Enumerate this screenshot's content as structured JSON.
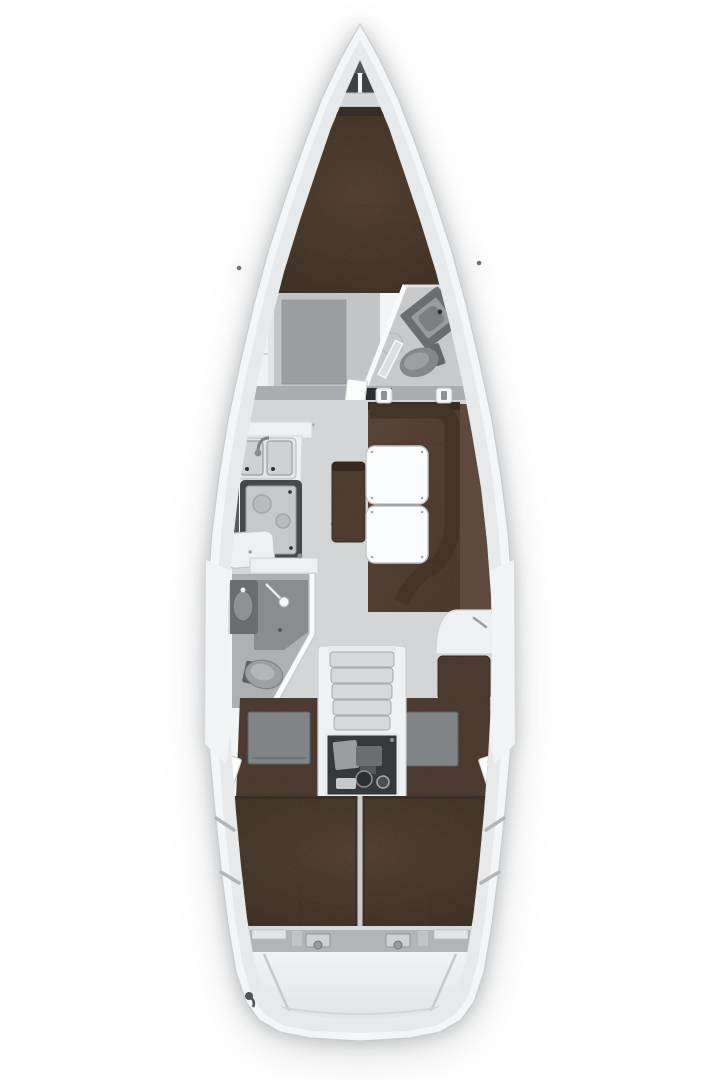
{
  "app": {
    "type": "boat-floorplan",
    "view": "top-down interior layout plan of a sailing yacht"
  },
  "palette": {
    "page_bg": "#ffffff",
    "hull": "#f4f5f6",
    "hull_stroke": "#c9ccce",
    "deck": "#e7e9ea",
    "walls": "#f3f4f5",
    "side_deck": "#f2f3f4",
    "floor": "#d3d5d7",
    "cabin_floor": "#c2c5c7",
    "rug": "#9c9fa2",
    "bath_floor": "#aeb1b4",
    "shower_floor": "#8a8d90",
    "berth_hi": "#62503f",
    "berth_lo": "#4b3b2f",
    "berth_top": "#382d26",
    "berth_edge": "#44352a",
    "sofa_seat_hi": "#6b5545",
    "sofa_seat_lo": "#5a4638",
    "sofa_back": "#443426",
    "sofa_shelf": "#5d4a3c",
    "bench": "#5f4c3c",
    "seam": "#4c3b2f",
    "table": "#fbfcfd",
    "table_stroke": "#c2c5c7",
    "counter": "#eef0f1",
    "counter_stroke": "#d0d3d5",
    "basin": "#cfd2d4",
    "basin_stroke": "#8f9295",
    "stove_frame": "#46494c",
    "stove_top": "#c6c9cb",
    "burner": "#aaadb0",
    "fixture": "#85888b",
    "fixture_dark": "#6b6e71",
    "fixture_light": "#9ca0a3",
    "engine_bay": "#36393c",
    "engine_metal": "#9b9ea1",
    "steps": "#d6d8da",
    "steps_edge": "#a7aaad",
    "sill": "#b2b5b8",
    "divider": "#c9ccce",
    "bulkhead": "#aaadb0",
    "doorway": "#2b2d2f",
    "door": "#fbfcfc",
    "locker": "#3f4245",
    "anchor_well": "#54575a",
    "shelf_band": "#d4d6d8",
    "transom_hi": "#f1f2f3",
    "transom_lo": "#e2e4e6"
  },
  "regions": [
    {
      "id": "anchor-locker"
    },
    {
      "id": "bow-shelves"
    },
    {
      "id": "v-berth-forward-cabin"
    },
    {
      "id": "wardrobe"
    },
    {
      "id": "forward-head"
    },
    {
      "id": "main-bulkhead"
    },
    {
      "id": "saloon"
    },
    {
      "id": "galley"
    },
    {
      "id": "dinette-tables"
    },
    {
      "id": "saloon-sofa"
    },
    {
      "id": "saloon-bench"
    },
    {
      "id": "aft-head"
    },
    {
      "id": "nav-station"
    },
    {
      "id": "companionway-steps"
    },
    {
      "id": "engine-compartment"
    },
    {
      "id": "aft-cabin-port"
    },
    {
      "id": "aft-cabin-starboard"
    },
    {
      "id": "aft-double-berth"
    },
    {
      "id": "transom-swim-platform"
    }
  ]
}
